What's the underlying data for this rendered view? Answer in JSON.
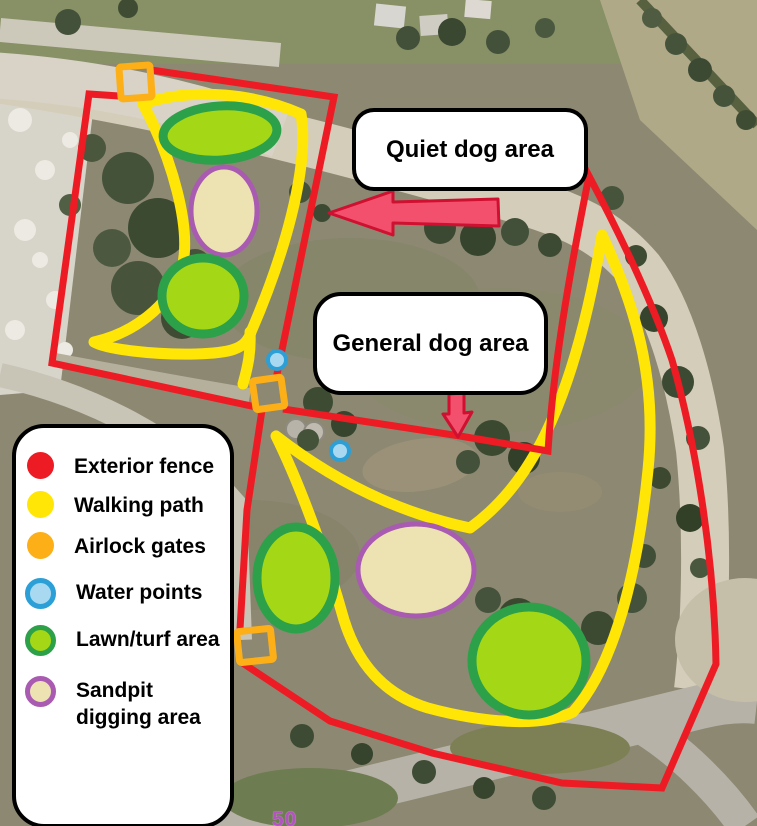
{
  "map": {
    "area_labels": [
      {
        "text": "Quiet dog area"
      },
      {
        "text": "General dog area"
      }
    ],
    "road_marking": "50"
  },
  "legend": {
    "items": [
      {
        "label": "Exterior fence"
      },
      {
        "label": "Walking path"
      },
      {
        "label": "Airlock gates"
      },
      {
        "label": "Water points"
      },
      {
        "label": "Lawn/turf area"
      },
      {
        "label": "Sandpit digging area"
      }
    ]
  },
  "colors": {
    "fence": "#ed1c24",
    "path": "#ffe607",
    "gate": "#fcaf17",
    "waterFill": "#a9d9f0",
    "waterRing": "#2b9fd6",
    "lawnFill": "#a4d816",
    "lawnRing": "#2da04a",
    "sandFill": "#ede2b2",
    "sandRing": "#a85bb0",
    "arrowFill": "#f3506d",
    "arrowRing": "#cf1030",
    "marking": "#b353c0",
    "labelBg": "#ffffff",
    "labelBorder": "#000000"
  }
}
